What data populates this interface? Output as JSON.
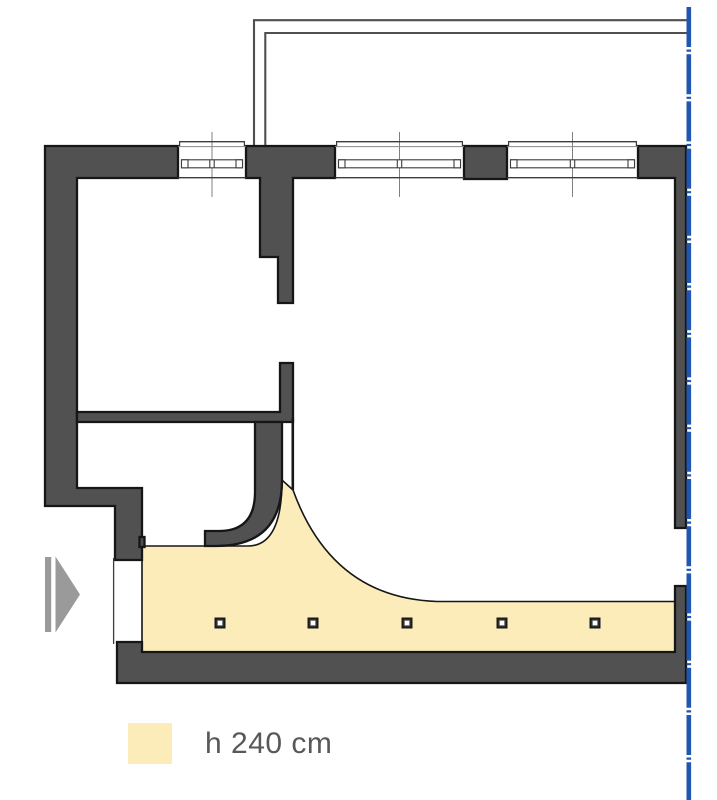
{
  "figure": {
    "kind": "apartment floor plan with lowered-ceiling zone",
    "legend": {
      "label": "h 240 cm"
    }
  },
  "colors": {
    "background": "#FFFFFF",
    "wall_fill": "#515151",
    "outline": "#161616",
    "ceiling_zone": "#FCECBA",
    "boundary_blue": "#2157B0",
    "arrow_gray": "#9A9A9A",
    "centerline_gray": "#808080",
    "thin_line": "#3C3C3C",
    "balcony_line": "#4F4F4F",
    "legend_text": "#58585A"
  },
  "ceiling_zone": {
    "height_label": "h 240 cm"
  },
  "spotlights": {
    "y": 623,
    "xs": [
      220,
      313,
      407,
      502,
      595
    ],
    "outer": 11,
    "inner": 4.6
  },
  "windows": [
    {
      "x1": 178,
      "x2": 246,
      "cx": 212
    },
    {
      "x1": 335,
      "x2": 464,
      "cx": 399.5
    },
    {
      "x1": 507,
      "x2": 638,
      "cx": 572.5
    }
  ]
}
